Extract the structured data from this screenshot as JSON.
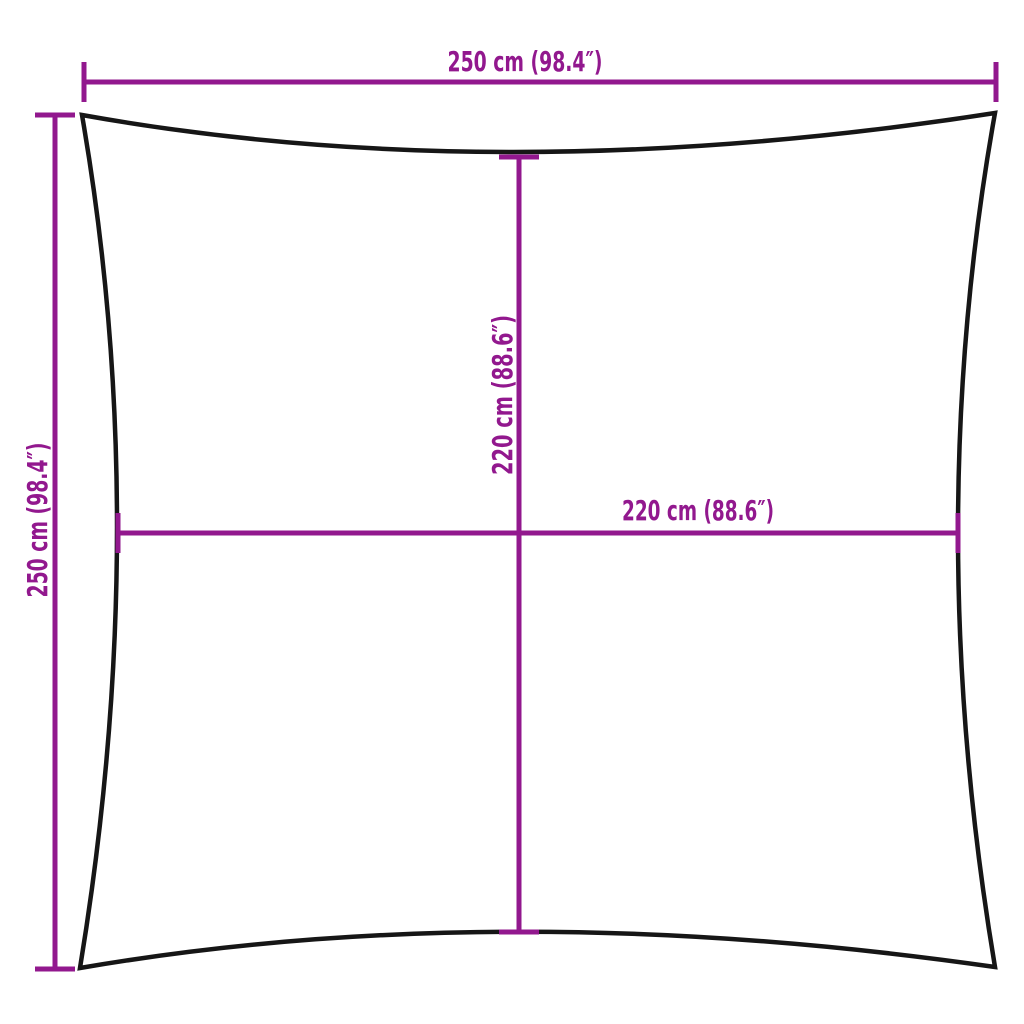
{
  "diagram": {
    "kind": "product-dimension-diagram",
    "subject": "square shade sail with concave edges",
    "dimensions": {
      "top": "250 cm (98.4″)",
      "left": "250 cm (98.4″)",
      "inner_vertical": "220 cm (88.6″)",
      "inner_horizontal": "220 cm (88.6″)"
    }
  },
  "colors": {
    "dimension": "#92188E",
    "outline": "#161616",
    "background": "#FFFFFF"
  }
}
